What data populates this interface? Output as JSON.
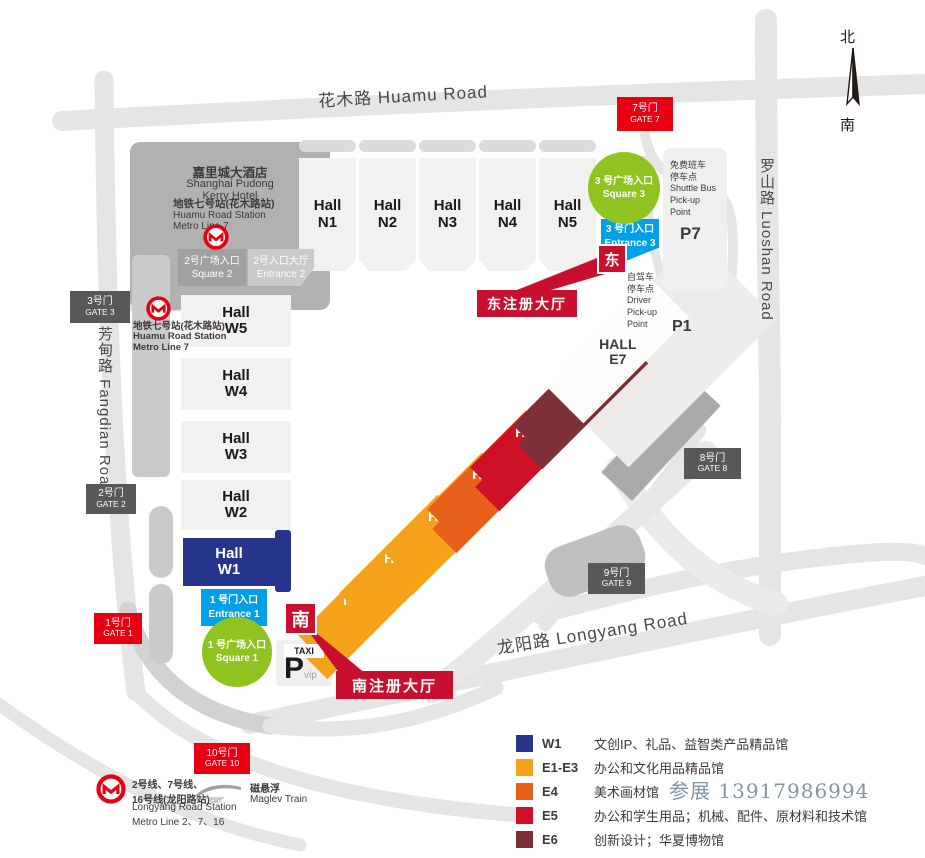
{
  "compass": {
    "north": "北",
    "south": "南"
  },
  "roads": {
    "huamu": "花木路 Huamu Road",
    "luoshan": "罗山路 Luoshan Road",
    "fangdian": "芳甸路 Fangdian Road",
    "longyang": "龙阳路 Longyang Road"
  },
  "gates": {
    "g1": {
      "zh": "1号门",
      "en": "GATE 1"
    },
    "g2": {
      "zh": "2号门",
      "en": "GATE 2"
    },
    "g3": {
      "zh": "3号门",
      "en": "GATE 3"
    },
    "g7": {
      "zh": "7号门",
      "en": "GATE 7"
    },
    "g8": {
      "zh": "8号门",
      "en": "GATE 8"
    },
    "g9": {
      "zh": "9号门",
      "en": "GATE 9"
    },
    "g10": {
      "zh": "10号门",
      "en": "GATE 10"
    }
  },
  "halls": {
    "n1": "Hall\nN1",
    "n2": "Hall\nN2",
    "n3": "Hall\nN3",
    "n4": "Hall\nN4",
    "n5": "Hall\nN5",
    "w1": "Hall\nW1",
    "w2": "Hall\nW2",
    "w3": "Hall\nW3",
    "w4": "Hall\nW4",
    "w5": "Hall\nW5",
    "e1": "HALL\nE1",
    "e2": "HALL\nE2",
    "e3": "HALL\nE3",
    "e4": "HALL\nE4",
    "e5": "HALL\nE5",
    "e6": "HALL\nE6",
    "e7": "HALL\nE7"
  },
  "entrances": {
    "square1": "1 号广场入口\nSquare 1",
    "entrance1": "1 号门入口\nEntrance 1",
    "square2": "2号广场入口\nSquare 2",
    "entrance2": "2号入口大厅\nEntrance 2",
    "square3": "3 号广场入口\nSquare 3",
    "entrance3": "3 号门入口\nEntrance 3"
  },
  "registration": {
    "south_marker": "南",
    "east_marker": "东",
    "south_hall": "南注册大厅",
    "east_hall": "东注册大厅"
  },
  "parking": {
    "p1": "P1",
    "p7": "P7",
    "taxi": "TAXI",
    "vip_p": "P",
    "vip_sub": "vip",
    "shuttle": "免费班车\n停车点\nShuttle Bus\nPick-up\nPoint",
    "driver": "自驾车\n停车点\nDriver\nPick-up\nPoint"
  },
  "landmarks": {
    "hotel_zh": "嘉里城大酒店",
    "hotel_en": "Shanghai Pudong\nKerry Hotel",
    "metro7_zh": "地铁七号站(花木路站)",
    "metro7_en": "Huamu Road Station\nMetro Line 7",
    "longyang_station_zh": "2号线、7号线、\n16号线(龙阳路站)",
    "longyang_station_en": "Longyang Road Station\nMetro Line 2、7、16",
    "maglev_zh": "磁悬浮",
    "maglev_en": "Maglev Train",
    "maglev_logo": "SMT"
  },
  "legend": {
    "rows": [
      {
        "code": "W1",
        "color": "#27348B",
        "text": "文创IP、礼品、益智类产品精品馆"
      },
      {
        "code": "E1-E3",
        "color": "#F5A21B",
        "text": "办公和文化用品精品馆"
      },
      {
        "code": "E4",
        "color": "#E8611A",
        "text": "美术画材馆"
      },
      {
        "code": "E5",
        "color": "#CE1126",
        "text": "办公和学生用品；机械、配件、原材料和技术馆"
      },
      {
        "code": "E6",
        "color": "#7D3038",
        "text": "创新设计；华夏博物馆"
      }
    ],
    "watermark": "参展  13917986994"
  },
  "colors": {
    "gate_red": "#E60012",
    "gate_gray": "#595757",
    "registration_red": "#C8102E",
    "entrance_blue": "#00A0E9",
    "square_green": "#8FC31F",
    "hall_navy": "#27348B",
    "hall_orange": "#F5A21B",
    "hall_orange_dark": "#E8611A",
    "hall_crimson": "#CE1126",
    "hall_maroon": "#7D3038",
    "road_gray": "#E5E5E3",
    "metro_red": "#E60012"
  }
}
